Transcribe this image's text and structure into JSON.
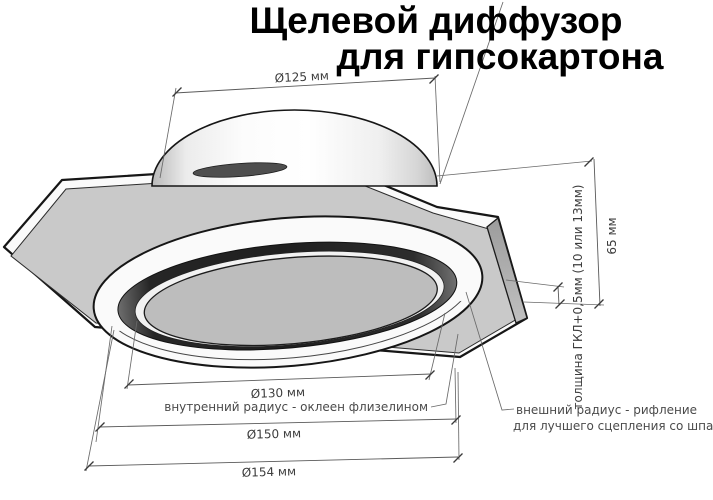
{
  "title": {
    "line1": "Щелевой диффузор",
    "line2": "для гипсокартона"
  },
  "dimensions": {
    "duct_diameter": {
      "label": "Ø125 мм"
    },
    "inner_diameter": {
      "label": "Ø130 мм"
    },
    "outer_diameter": {
      "label": "Ø150 мм"
    },
    "flange_diameter": {
      "label": "Ø154 мм"
    },
    "total_height": {
      "label": "65 мм"
    },
    "plate_thickness": {
      "label": "толщина ГКЛ+0,5мм (10 или 13мм)"
    }
  },
  "annotations": {
    "inner_radius": {
      "label": "внутренний радиус - оклеен флизелином"
    },
    "outer_radius": {
      "line1": "внешний радиус - рифление",
      "line2": "для лучшего сцепления со шпаклёвкой"
    }
  },
  "colors": {
    "background": "#ffffff",
    "outline": "#1a1a1a",
    "plate_top": "#c9c9c9",
    "plate_side": "#a8a8a8",
    "white_surface": "#fafafa",
    "diffuser_lip": "#f2f2f2",
    "diffuser_disc": "#bdbdbd",
    "slot_dark": "#242424",
    "duct_opening": "#4e4e4e",
    "dim_line": "#5a5a5a",
    "dim_text": "#3d3d3d",
    "title_text": "#000000"
  }
}
